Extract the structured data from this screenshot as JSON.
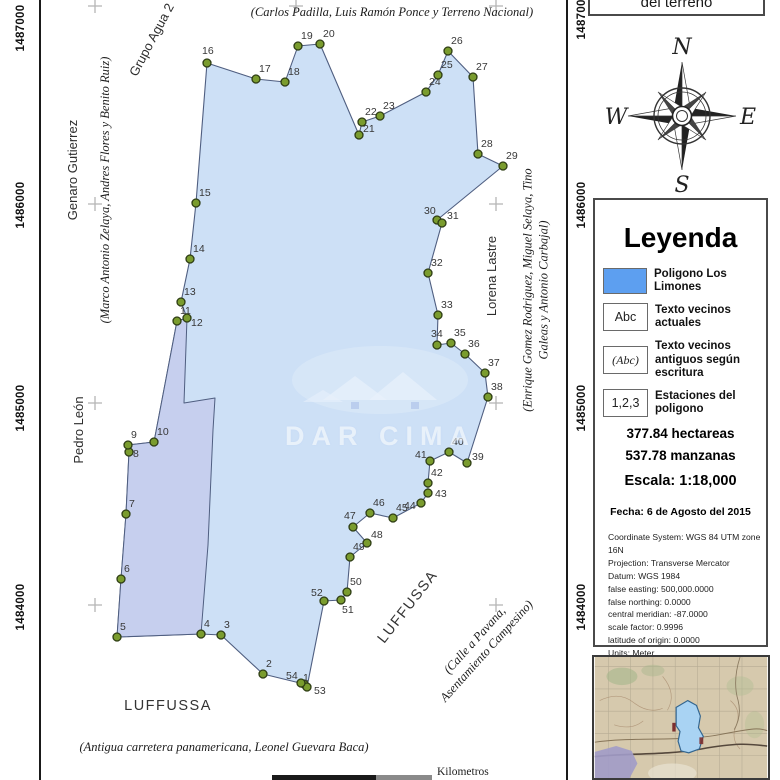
{
  "header": {
    "title_partial": "del terreno"
  },
  "compass": {
    "north": "N",
    "south": "S",
    "east": "E",
    "west": "W"
  },
  "map": {
    "parcel_name": "Poligono Los Limones",
    "watermark_text": "DAR CIMA",
    "scale_bar_label": "Kilometros",
    "axis_labels_left": [
      {
        "text": "1487000",
        "y": 28
      },
      {
        "text": "1486000",
        "y": 205
      },
      {
        "text": "1485000",
        "y": 408
      },
      {
        "text": "1484000",
        "y": 607
      }
    ],
    "axis_labels_right": [
      {
        "text": "1487000",
        "y": 16
      },
      {
        "text": "1486000",
        "y": 205
      },
      {
        "text": "1485000",
        "y": 408
      },
      {
        "text": "1484000",
        "y": 607
      }
    ],
    "grid_crosses": [
      [
        95,
        6
      ],
      [
        296,
        6
      ],
      [
        496,
        6
      ],
      [
        95,
        204
      ],
      [
        296,
        204
      ],
      [
        496,
        204
      ],
      [
        95,
        403
      ],
      [
        296,
        403
      ],
      [
        496,
        403
      ],
      [
        95,
        605
      ],
      [
        296,
        605
      ],
      [
        496,
        605
      ]
    ],
    "colors": {
      "parcel_fill": "#cde0f6",
      "subparcel_fill": "#c6cfee",
      "parcel_stroke": "#4f5e80",
      "dot_fill": "#7a9c2e",
      "dot_stroke": "#2e3d14",
      "label_color": "#383838",
      "cross_color": "#b5b5b5"
    },
    "vertices": [
      {
        "n": 1,
        "x": 304,
        "y": 684,
        "dx": -1,
        "dy": -3
      },
      {
        "n": 2,
        "x": 263,
        "y": 674
      },
      {
        "n": 3,
        "x": 221,
        "y": 635
      },
      {
        "n": 4,
        "x": 201,
        "y": 634
      },
      {
        "n": 5,
        "x": 117,
        "y": 637
      },
      {
        "n": 6,
        "x": 121,
        "y": 579
      },
      {
        "n": 7,
        "x": 126,
        "y": 514
      },
      {
        "n": 8,
        "x": 129,
        "y": 452,
        "dx": 4,
        "dy": 5
      },
      {
        "n": 9,
        "x": 128,
        "y": 445
      },
      {
        "n": 10,
        "x": 154,
        "y": 442
      },
      {
        "n": 11,
        "x": 177,
        "y": 321
      },
      {
        "n": 12,
        "x": 187,
        "y": 318,
        "dx": 4,
        "dy": 8
      },
      {
        "n": 13,
        "x": 181,
        "y": 302
      },
      {
        "n": 14,
        "x": 190,
        "y": 259
      },
      {
        "n": 15,
        "x": 196,
        "y": 203
      },
      {
        "n": 16,
        "x": 207,
        "y": 63,
        "dx": -5,
        "dy": -9
      },
      {
        "n": 17,
        "x": 256,
        "y": 79
      },
      {
        "n": 18,
        "x": 285,
        "y": 82
      },
      {
        "n": 19,
        "x": 298,
        "y": 46
      },
      {
        "n": 20,
        "x": 320,
        "y": 44
      },
      {
        "n": 21,
        "x": 359,
        "y": 135,
        "dx": 4,
        "dy": -3
      },
      {
        "n": 22,
        "x": 362,
        "y": 122
      },
      {
        "n": 23,
        "x": 380,
        "y": 116
      },
      {
        "n": 24,
        "x": 426,
        "y": 92
      },
      {
        "n": 25,
        "x": 438,
        "y": 75
      },
      {
        "n": 26,
        "x": 448,
        "y": 51
      },
      {
        "n": 27,
        "x": 473,
        "y": 77
      },
      {
        "n": 28,
        "x": 478,
        "y": 154
      },
      {
        "n": 29,
        "x": 503,
        "y": 166
      },
      {
        "n": 30,
        "x": 437,
        "y": 220,
        "dx": -13,
        "dy": -6
      },
      {
        "n": 31,
        "x": 442,
        "y": 223,
        "dx": 5,
        "dy": -4
      },
      {
        "n": 32,
        "x": 428,
        "y": 273
      },
      {
        "n": 33,
        "x": 438,
        "y": 315
      },
      {
        "n": 34,
        "x": 437,
        "y": 345,
        "dx": -6,
        "dy": -8
      },
      {
        "n": 35,
        "x": 451,
        "y": 343
      },
      {
        "n": 36,
        "x": 465,
        "y": 354
      },
      {
        "n": 37,
        "x": 485,
        "y": 373
      },
      {
        "n": 38,
        "x": 488,
        "y": 397
      },
      {
        "n": 39,
        "x": 467,
        "y": 463,
        "dx": 5,
        "dy": -3
      },
      {
        "n": 40,
        "x": 449,
        "y": 452
      },
      {
        "n": 41,
        "x": 430,
        "y": 461,
        "dx": -15,
        "dy": -3
      },
      {
        "n": 42,
        "x": 428,
        "y": 483
      },
      {
        "n": 43,
        "x": 428,
        "y": 493,
        "dx": 7,
        "dy": 4
      },
      {
        "n": 44,
        "x": 421,
        "y": 503,
        "dx": -17,
        "dy": 6
      },
      {
        "n": 45,
        "x": 393,
        "y": 518
      },
      {
        "n": 46,
        "x": 370,
        "y": 513
      },
      {
        "n": 47,
        "x": 353,
        "y": 527,
        "dx": -9,
        "dy": -8
      },
      {
        "n": 48,
        "x": 367,
        "y": 543,
        "dx": 4,
        "dy": -5
      },
      {
        "n": 49,
        "x": 350,
        "y": 557
      },
      {
        "n": 50,
        "x": 347,
        "y": 592
      },
      {
        "n": 51,
        "x": 341,
        "y": 600,
        "dx": 1,
        "dy": 13
      },
      {
        "n": 52,
        "x": 324,
        "y": 601,
        "dx": -13,
        "dy": -5
      },
      {
        "n": 53,
        "x": 307,
        "y": 687,
        "dx": 7,
        "dy": 7
      },
      {
        "n": 54,
        "x": 301,
        "y": 683,
        "dx": -15,
        "dy": -4
      }
    ],
    "subparcel_points": [
      [
        177,
        321
      ],
      [
        187,
        318
      ],
      [
        184,
        403
      ],
      [
        215,
        398
      ],
      [
        213,
        430
      ],
      [
        208,
        545
      ],
      [
        201,
        634
      ],
      [
        117,
        637
      ],
      [
        121,
        579
      ],
      [
        126,
        514
      ],
      [
        129,
        452
      ],
      [
        128,
        445
      ],
      [
        154,
        442
      ]
    ],
    "neighbors": [
      {
        "id": "grupo-agua",
        "text": "Grupo Agua 2",
        "x": 152,
        "y": 40,
        "rot": -62,
        "style": "sans"
      },
      {
        "id": "carlos-padilla",
        "text": "(Carlos Padilla, Luis Ramón Ponce y Terreno Nacional)",
        "x": 392,
        "y": 13,
        "rot": 0,
        "style": "serif"
      },
      {
        "id": "genaro-gutierrez",
        "text": "Genaro Gutierrez",
        "x": 73,
        "y": 170,
        "rot": -90,
        "style": "sans"
      },
      {
        "id": "marco-antonio",
        "text": "(Marco Antonio Zelaya, Andres Flores y Benito Ruiz)",
        "x": 106,
        "y": 190,
        "rot": -90,
        "style": "serif"
      },
      {
        "id": "pedro-leon",
        "text": "Pedro León",
        "x": 79,
        "y": 430,
        "rot": -90,
        "style": "sans"
      },
      {
        "id": "lorena-lastre",
        "text": "Lorena Lastre",
        "x": 492,
        "y": 276,
        "rot": -90,
        "style": "sans"
      },
      {
        "id": "enrique-gomez",
        "text": "(Enrique Gomez Rodriguez, Miguel Selaya, Tino Galeas y Antonio Carbajal)",
        "x": 536,
        "y": 290,
        "rot": -90,
        "style": "serif"
      },
      {
        "id": "luffussa-south",
        "text": "LUFFUSSA",
        "x": 168,
        "y": 706,
        "rot": 0,
        "style": "sans-big"
      },
      {
        "id": "luffussa-east",
        "text": "LUFFUSSA",
        "x": 408,
        "y": 607,
        "rot": -52,
        "style": "sans-big"
      },
      {
        "id": "calle-pavana",
        "text": "(Calle a Pavana,\nAsentamiento Campesino)",
        "x": 481,
        "y": 646,
        "rot": -48,
        "style": "serif"
      },
      {
        "id": "antigua-carretera",
        "text": "(Antigua carretera panamericana, Leonel Guevara Baca)",
        "x": 224,
        "y": 748,
        "rot": 0,
        "style": "serif"
      }
    ]
  },
  "legend": {
    "title": "Leyenda",
    "accent_color": "#5d9ff0",
    "items": [
      {
        "label": "Poligono Los Limones"
      },
      {
        "swatch_text": "Abc",
        "label": "Texto vecinos actuales"
      },
      {
        "swatch_text": "(Abc)",
        "label": "Texto vecinos antiguos según escritura"
      },
      {
        "swatch_text": "1,2,3",
        "label": "Estaciones del poligono"
      }
    ],
    "area_hectareas": "377.84 hectareas",
    "area_manzanas": "537.78 manzanas",
    "escala": "Escala: 1:18,000",
    "fecha": "Fecha: 6 de Agosto del 2015",
    "crs_lines": [
      "Coordinate System: WGS 84 UTM zone 16N",
      "Projection: Transverse Mercator",
      "Datum: WGS 1984",
      "false easting: 500,000.0000",
      "false northing: 0.0000",
      "central meridian: -87.0000",
      "scale factor: 0.9996",
      "latitude of origin: 0.0000",
      "Units: Meter"
    ],
    "code": "COLPRFORH 656",
    "author": "Autor: Lorenzo Olivas"
  }
}
